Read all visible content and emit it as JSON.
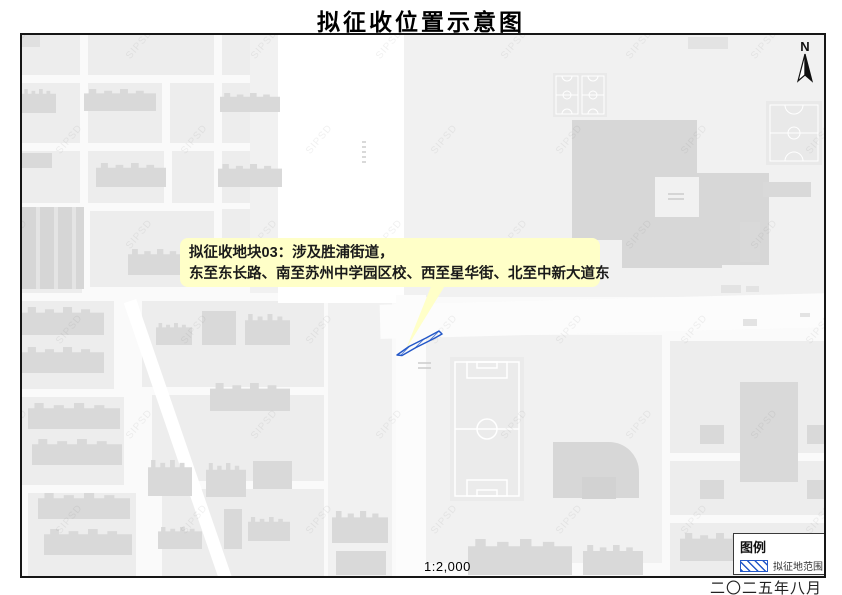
{
  "title": "拟征收位置示意图",
  "map": {
    "callout": {
      "line1": "拟征收地块03：涉及胜浦街道，",
      "line2": "东至东长路、南至苏州中学园区校、西至星华街、北至中新大道东"
    },
    "north_arrow": {
      "label": "N"
    },
    "scale_text": "1:2,000",
    "legend": {
      "title": "图例",
      "items": [
        {
          "symbol": "blue-diagonal-hatch-swatch",
          "label": "拟征地范围"
        }
      ]
    },
    "watermark_text": "SIPSD"
  },
  "date_text": "二〇二五年八月",
  "colors": {
    "callout_bg": "#FFFFC8",
    "acquisition_blue": "#2458C8",
    "building_gray": "#D9D9D9",
    "parcel_gray": "#EDEDED",
    "map_bg": "#FAFAFA"
  }
}
